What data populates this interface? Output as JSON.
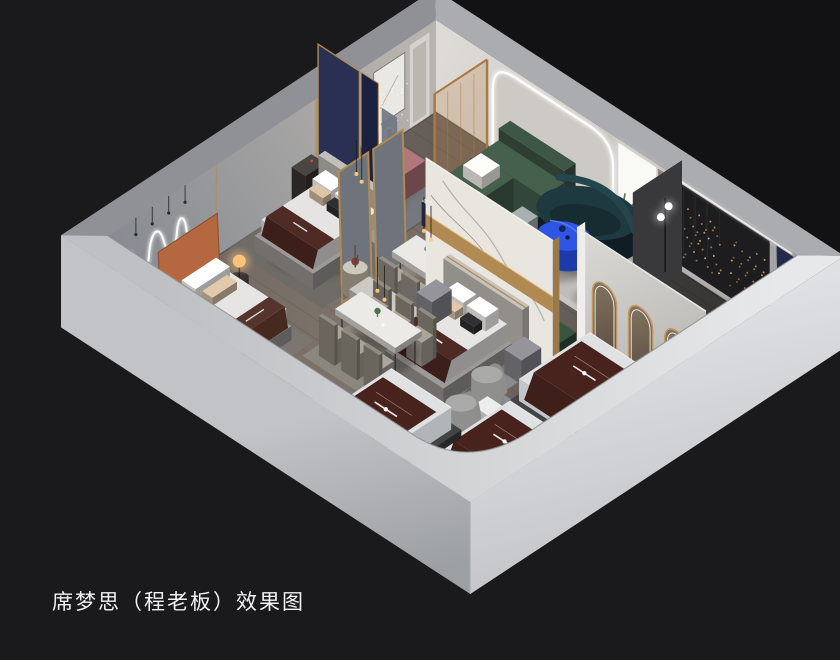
{
  "caption": {
    "text": "席梦思（程老板）效果图"
  },
  "palette": {
    "background": "#1a1a1c",
    "backdrop_dark": "#121214",
    "wall_gray_outer": "#a2a4a8",
    "wall_gray_outer_dark": "#8f9196",
    "wall_top": "#aaacb0",
    "wall_white_outer": "#d9dadd",
    "wall_inner_light": "#b7b3ae",
    "wall_inner_cool": "#7f848c",
    "wall_inner_ne": "#dedbd7",
    "dark_media_wall": "#1d1c1e",
    "navy_panel": "#23284a",
    "navy_wall": "#242a4b",
    "floor_light": "#7c736b",
    "floor_mid": "#6e665f",
    "floor_dark": "#45423f",
    "rug_light": "#c8c7c5",
    "rug_cool": "#8e9297",
    "accent_blue": "#2e55e3",
    "accent_blue_deep": "#2343bb",
    "accent_teal": "#1e3a40",
    "accent_teal_dark": "#101e24",
    "accent_green": "#3e5747",
    "accent_green_dark": "#2e4636",
    "accent_gold": "#b08a52",
    "marble": "#e9e5df",
    "runner_brown": "#4e2b24",
    "runner_brown_dark": "#3c1f1a",
    "bed_white": "#e5e4e2",
    "mauve": "#a26b72",
    "burgundy": "#7d3b43",
    "orange_headboard": "#b5673f",
    "lamp_warm": "#ffc97e",
    "fairy_light": "#d8a96b",
    "led_white": "#ffffff",
    "silver": "#ced1d4",
    "caption_color": "#f2f2f2"
  },
  "scene_areas": [
    "entry-lounge",
    "bedroom-display-1",
    "bedroom-display-2",
    "bedroom-display-3",
    "dining-display-1",
    "dining-display-2",
    "living-room-display",
    "dark-bedroom-display",
    "mattress-display-row",
    "window-display-platforms"
  ]
}
